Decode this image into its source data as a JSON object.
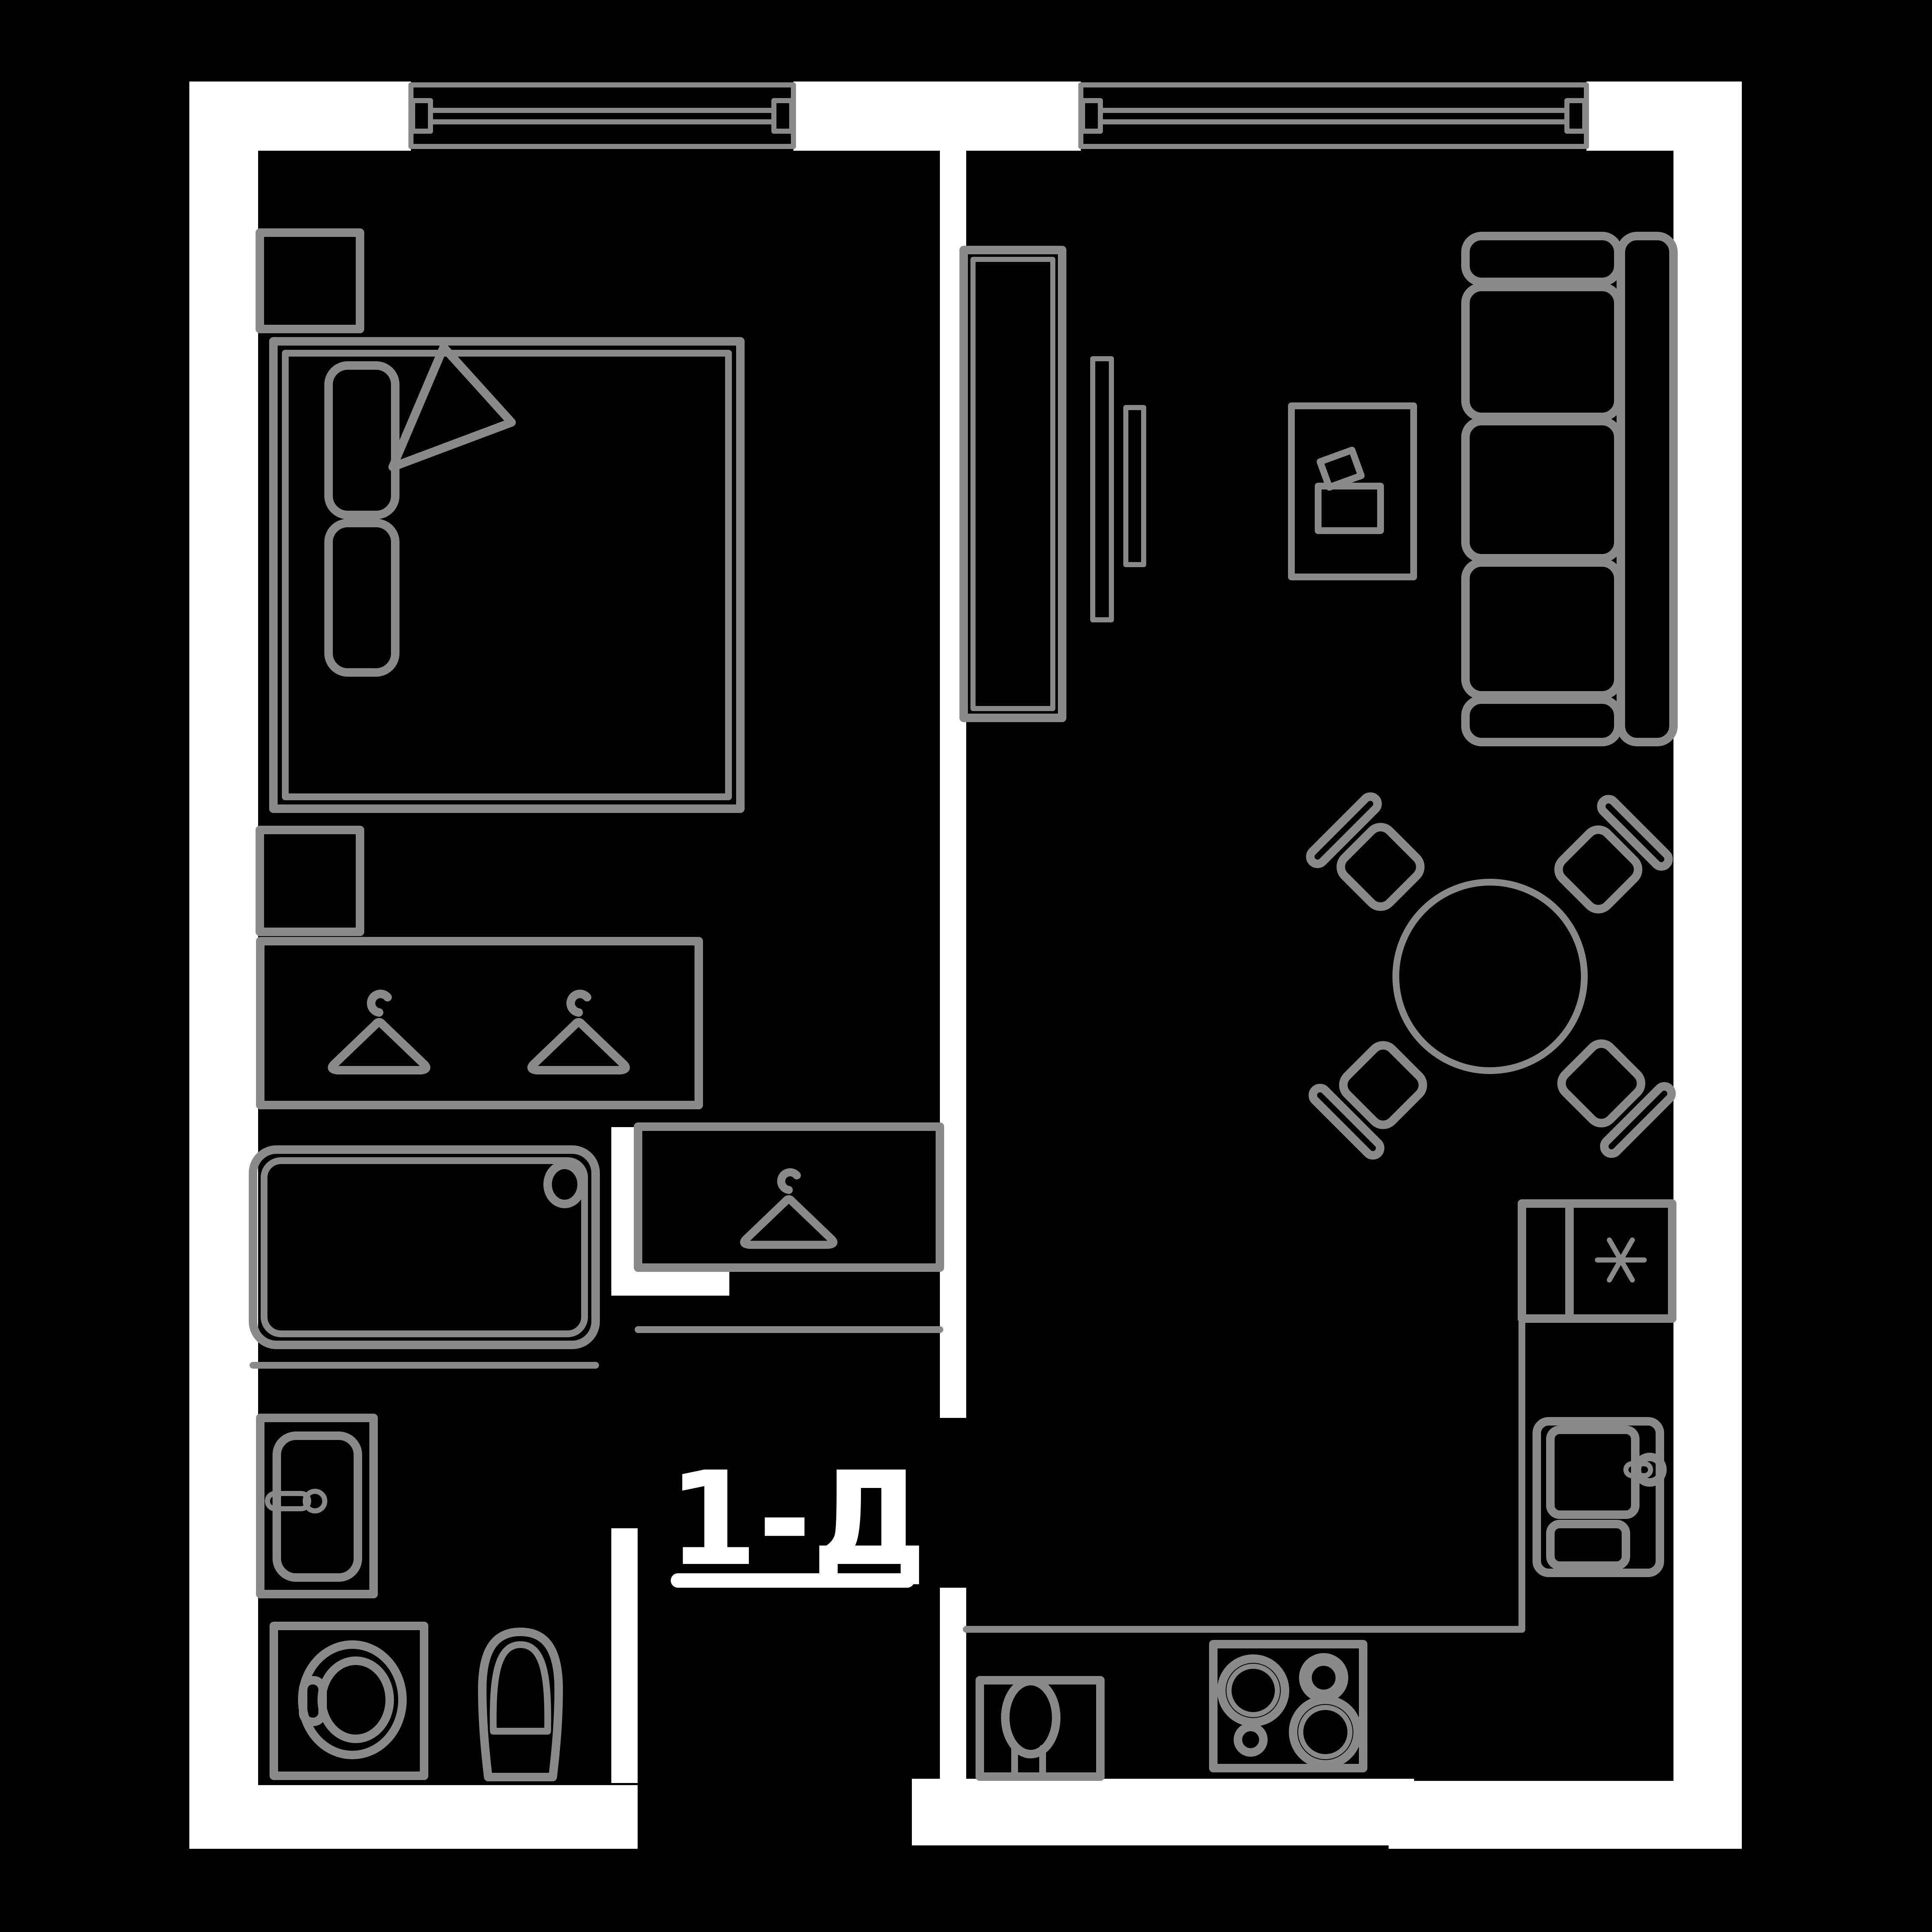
{
  "page": {
    "type": "apartment-floor-plan"
  },
  "label": {
    "text": "1-Д"
  },
  "colors": {
    "background": "#000000",
    "wall": "#ffffff",
    "furniture_line": "#8a8a8a",
    "label_text": "#ffffff"
  },
  "fixtures": [
    "window",
    "bed",
    "pillow",
    "blanket-fold",
    "nightstand",
    "wardrobe",
    "hanger",
    "closet",
    "shelf",
    "bathtub",
    "bath-sink",
    "washing-machine",
    "toilet",
    "fridge",
    "snowflake",
    "kitchen-sink",
    "faucet",
    "small-sink",
    "stove",
    "burner",
    "counter",
    "dining-table",
    "chair",
    "sofa",
    "tv-unit",
    "desk"
  ]
}
